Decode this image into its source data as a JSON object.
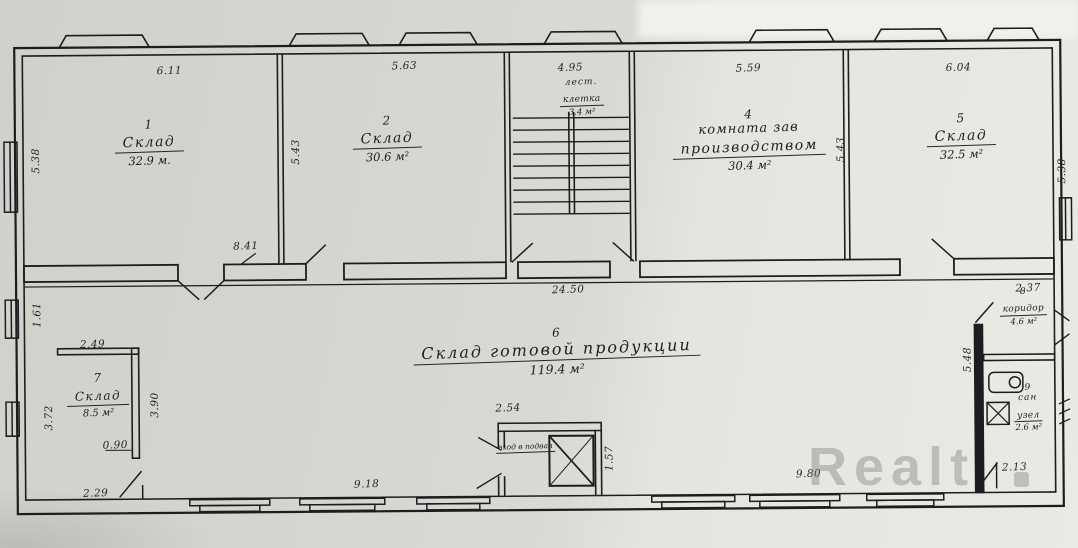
{
  "watermark": {
    "text": "Realt"
  },
  "colors": {
    "ink": "#1d1d20",
    "paper": "#d8d6d1",
    "watermark_gray": "#808082"
  },
  "rooms": {
    "r1": {
      "num": "1",
      "name": "Склад",
      "area": "32.9 м."
    },
    "r2": {
      "num": "2",
      "name": "Склад",
      "area": "30.6 м²"
    },
    "stairs": {
      "name1": "лест.",
      "name2": "клетка",
      "area": "3.4 м²"
    },
    "r4": {
      "num": "4",
      "name1": "комната зав",
      "name2": "производством",
      "area": "30.4 м²"
    },
    "r5": {
      "num": "5",
      "name": "Склад",
      "area": "32.5 м²"
    },
    "r6": {
      "num": "6",
      "name": "Склад готовой продукции",
      "area": "119.4 м²"
    },
    "r7": {
      "num": "7",
      "name": "Склад",
      "area": "8.5 м²"
    },
    "r8": {
      "num": "8",
      "name": "коридор",
      "area": "4.6 м²"
    },
    "r9": {
      "num": "9",
      "name1": "сан",
      "name2": "узел",
      "area": "2.6 м²"
    },
    "basement": {
      "name": "вход в подвал"
    }
  },
  "dims": {
    "top1": "6.11",
    "top2": "5.63",
    "top3": "4.95",
    "top4": "5.59",
    "top5": "6.04",
    "left1": "5.38",
    "left2": "1.61",
    "mid1": "5.43",
    "mid2": "5.43",
    "right1": "5.38",
    "door": "8.41",
    "hall": "24.50",
    "r7top": "2.49",
    "r7right": "3.90",
    "r7left": "3.72",
    "r7door": "0.90",
    "r7bottom": "2.29",
    "bottom1": "9.18",
    "bottom2": "9.80",
    "bottom3": "2.13",
    "elevtop": "2.54",
    "elevright": "1.57",
    "r8top": "2.37",
    "r8left": "5.48"
  }
}
